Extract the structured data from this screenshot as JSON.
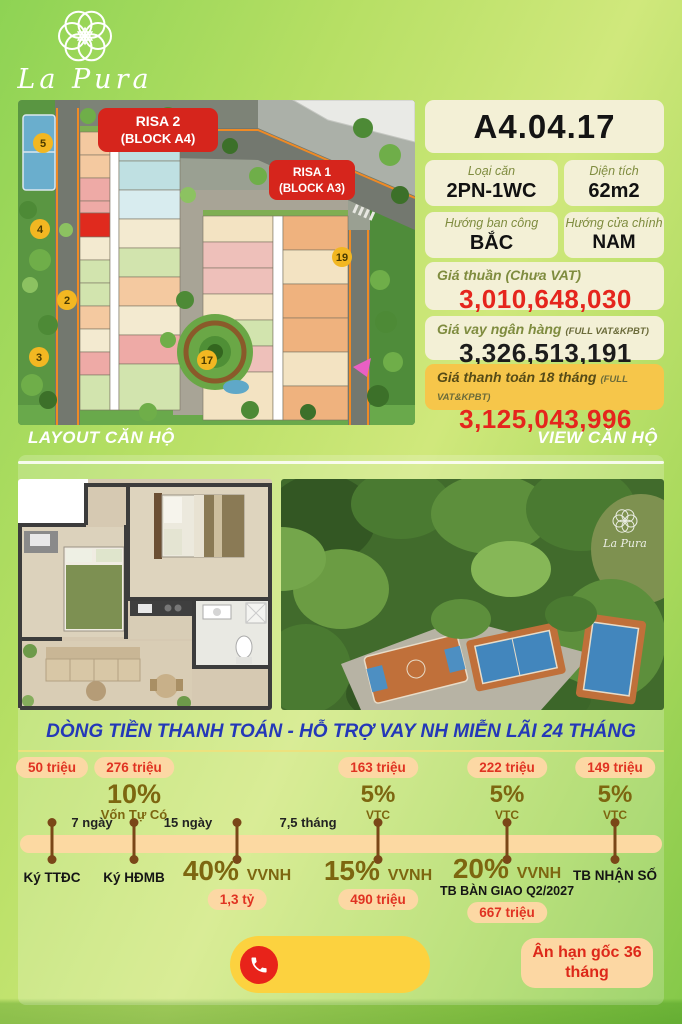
{
  "brand": {
    "name": "La Pura"
  },
  "site_plan": {
    "block_labels": [
      {
        "line1": "RISA 2",
        "line2": "(BLOCK A4)"
      },
      {
        "line1": "RISA 1",
        "line2": "(BLOCK A3)"
      }
    ],
    "markers": [
      "5",
      "4",
      "2",
      "3",
      "17",
      "19"
    ]
  },
  "unit": {
    "code": "A4.04.17",
    "fields": [
      {
        "label": "Loại căn",
        "value": "2PN-1WC"
      },
      {
        "label": "Diện tích",
        "value": "62m2"
      },
      {
        "label": "Hướng ban công",
        "value": "BẮC"
      },
      {
        "label": "Hướng cửa chính",
        "value": "NAM"
      }
    ],
    "prices": [
      {
        "label": "Giá thuần (Chưa VAT)",
        "note": "",
        "value": "3,010,648,030"
      },
      {
        "label": "Giá vay ngân hàng",
        "note": "(FULL VAT&KPBT)",
        "value": "3,326,513,191"
      },
      {
        "label": "Giá thanh toán 18 tháng",
        "note": "(FULL VAT&KPBT)",
        "value": "3,125,043,996"
      }
    ]
  },
  "sections": {
    "layout": "LAYOUT CĂN HỘ",
    "view": "VIEW CĂN HỘ"
  },
  "view_image": {
    "watermark": "La Pura"
  },
  "payment": {
    "title": "DÒNG TIỀN THANH TOÁN - HỖ TRỢ VAY NH MIỄN LÃI 24 THÁNG",
    "intervals": [
      "7 ngày",
      "15 ngày",
      "7,5 tháng"
    ],
    "milestones": [
      {
        "above_badge": "50 triệu",
        "below_label": "Ký TTĐC"
      },
      {
        "above_badge": "276 triệu",
        "above_pct": "10%",
        "above_pct_label": "Vốn Tự Có",
        "below_label": "Ký HĐMB"
      },
      {
        "below_pct": "40%",
        "below_pct_label": "VVNH",
        "below_badge": "1,3 tỷ"
      },
      {
        "above_badge": "163 triệu",
        "above_pct": "5%",
        "above_pct_label": "VTC",
        "below_pct": "15%",
        "below_pct_label": "VVNH",
        "below_badge": "490 triệu"
      },
      {
        "above_badge": "222 triệu",
        "above_pct": "5%",
        "above_pct_label": "VTC",
        "below_pct": "20%",
        "below_pct_label": "VVNH",
        "below_note": "TB BÀN GIAO Q2/2027",
        "below_badge": "667 triệu"
      },
      {
        "above_badge": "149 triệu",
        "above_pct": "5%",
        "above_pct_label": "VTC",
        "below_label": "TB NHẬN SỐ"
      }
    ]
  },
  "footer": {
    "grace": "Ân hạn gốc 36 tháng"
  },
  "colors": {
    "accent_red": "#e5251d",
    "brand_green": "#8ed354",
    "card_cream": "#f3f0d6",
    "card_amber": "#f6c64a",
    "timeline_bar": "#fcd9a2",
    "title_blue": "#2438b8",
    "label_red": "#d6251c"
  }
}
